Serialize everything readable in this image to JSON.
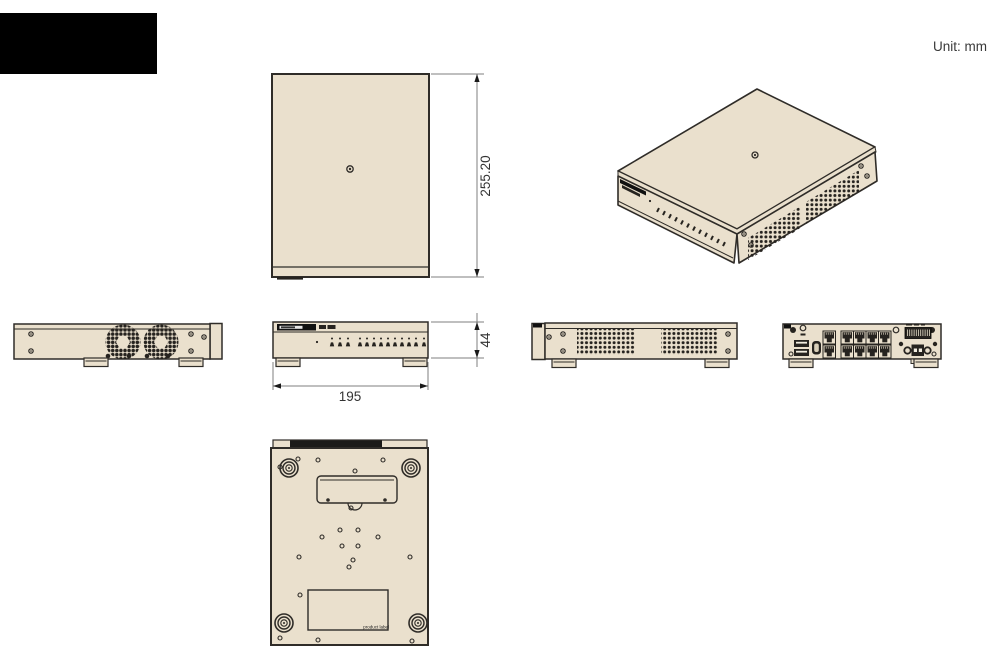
{
  "page": {
    "unit_label": "Unit: mm"
  },
  "dimensions": {
    "depth_mm": "255.20",
    "height_mm": "44",
    "width_mm": "195"
  },
  "bottom_view": {
    "product_label_text": "product label"
  },
  "colors": {
    "body_fill": "#eae0cd",
    "outline": "#2f2c28",
    "vent_dark": "#26231f",
    "dimension_line": "#7f7f7f",
    "dimension_text": "#333333",
    "logo_block": "#000000",
    "background": "#ffffff"
  }
}
